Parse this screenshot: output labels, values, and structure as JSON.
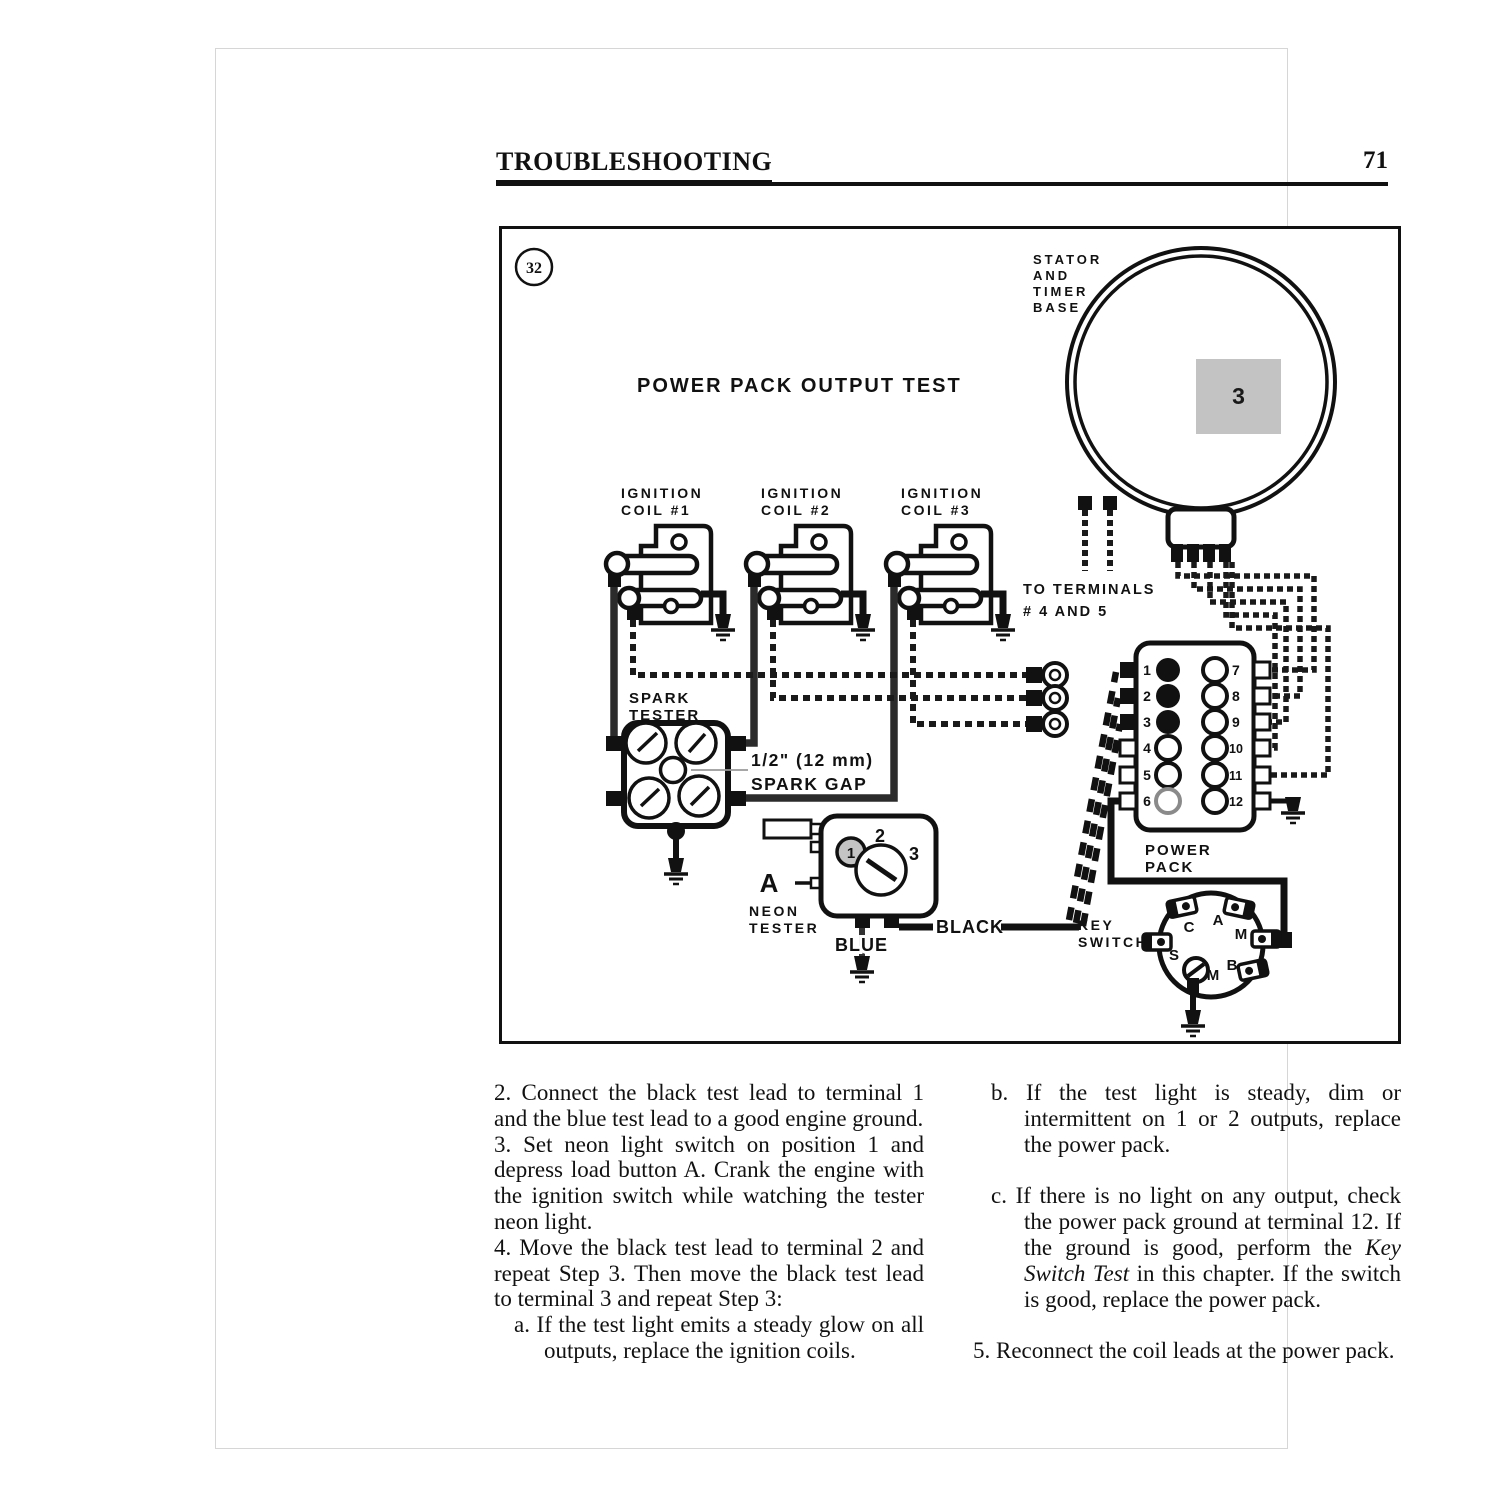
{
  "header": {
    "title": "TROUBLESHOOTING",
    "page_number": "71"
  },
  "chapter_tab": {
    "label": "3"
  },
  "figure": {
    "number": "32",
    "title": "POWER PACK OUTPUT TEST",
    "stator_label": [
      "STATOR",
      "AND",
      "TIMER",
      "BASE"
    ],
    "terminals_note": [
      "TO  TERMINALS",
      "# 4  AND  5"
    ],
    "coil1_label": [
      "IGNITION",
      "COIL   #1"
    ],
    "coil2_label": [
      "IGNITION",
      "COIL   #2"
    ],
    "coil3_label": [
      "IGNITION",
      "COIL   #3"
    ],
    "spark_tester_label": [
      "SPARK",
      "TESTER"
    ],
    "spark_gap_label": [
      "1/2\"  (12 mm)",
      "SPARK  GAP"
    ],
    "neon_tester_label": [
      "NEON",
      "TESTER"
    ],
    "load_button_label": "A",
    "neon_positions": [
      "1",
      "2",
      "3"
    ],
    "black_lead_label": "BLACK",
    "blue_lead_label": "BLUE",
    "power_pack_label": [
      "POWER",
      "PACK"
    ],
    "power_pack_terminals_left": [
      "1",
      "2",
      "3",
      "4",
      "5",
      "6"
    ],
    "power_pack_terminals_right": [
      "7",
      "8",
      "9",
      "10",
      "11",
      "12"
    ],
    "key_switch_label": [
      "KEY",
      "SWITCH"
    ],
    "key_switch_terminals": [
      "C",
      "A",
      "M",
      "S",
      "B",
      "M"
    ]
  },
  "body": {
    "left_column": {
      "item2": "2.  Connect the black test lead to terminal 1 and the blue test lead to a good engine ground.",
      "item3": "3.  Set neon light switch on position 1 and depress load button A. Crank the engine with the ignition switch while watching the tester neon light.",
      "item4": "4.  Move the black test lead to terminal 2 and repeat Step 3. Then move the black test lead to terminal 3 and repeat Step 3:",
      "item4a": "a.  If the test light emits a steady glow on all outputs, replace the ignition coils."
    },
    "right_column": {
      "item_b": "b.  If the test light is steady, dim or intermittent on 1 or 2 outputs, replace the power pack.",
      "item_c_pre": "c.  If there is no light on any output, check the power pack ground at terminal 12. If the ground is good, perform the ",
      "item_c_italic": "Key Switch Test",
      "item_c_post": " in this chapter. If the switch is good, replace the power pack.",
      "item5": "5.  Reconnect the coil leads at the power pack."
    }
  },
  "colors": {
    "tab_gray": "#c3c3c3",
    "ink": "#111111"
  }
}
